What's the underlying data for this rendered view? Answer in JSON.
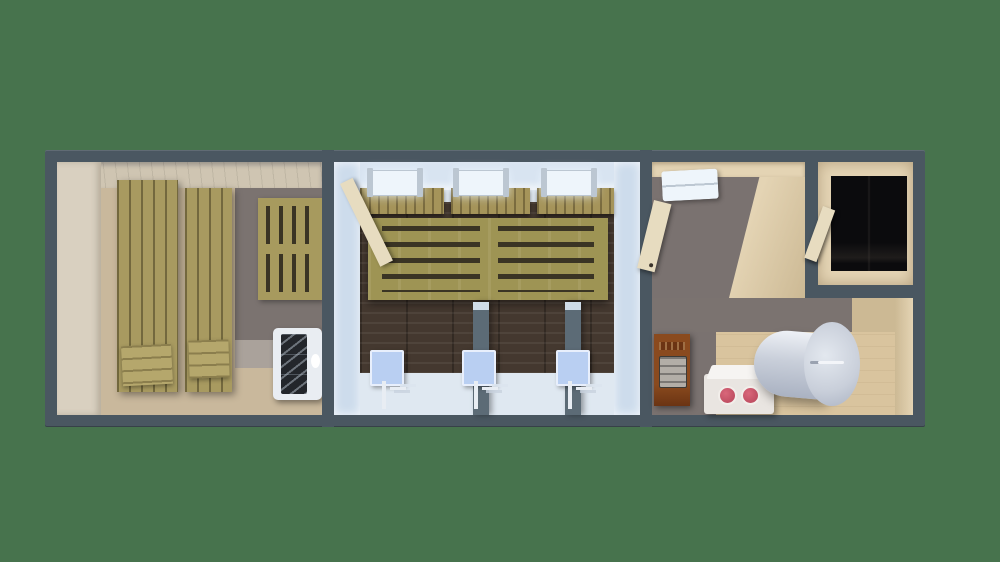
{
  "title": "3D top-down cutaway floor plan of a sauna building",
  "palette": {
    "bg": "#47734d",
    "frame": "#4a5761",
    "sauna-ceiling": "#cfc5b2",
    "sauna-wall": "#d9d0c0",
    "sauna-floor": "#c9b89c",
    "bench": "#a89a60",
    "bench-light": "#b5a76c",
    "pallet": "#a79a5e",
    "slot": "#3a3424",
    "barnwood": "#7b7370",
    "barnwood-light": "#aaa29b",
    "heater": "#e9edf2",
    "grille": "#23262b",
    "tile-wall": "#cddcec",
    "tile-top": "#d8e4f1",
    "tile-floor": "#dfe8f1",
    "dark-wall": "#44382f",
    "cabinet": "#a5945a",
    "shower-bench": "#9e9454",
    "light-fix": "#eef5fb",
    "light-cap": "#bcc7d2",
    "partition": "#5c6b76",
    "partition-top": "#cfdce8",
    "head": "#b9cff2",
    "pipe": "#e8edf3",
    "door": "#e7dcc0",
    "beige": "#e4d4b4",
    "beige-shade": "#ccb994",
    "beige-floor": "#d9c49e",
    "hall-floor": "#7a7270",
    "dark-floor": "#0b0b0d",
    "stove": "#8a4a1e",
    "stove-dark": "#6b3413",
    "stove-panel": "#b3aea7",
    "box": "#e9e5e1",
    "box-top": "#f6f4f2",
    "knob": "#c04f63",
    "boiler-hi": "#eef1f6",
    "boiler-mid": "#c9cfda",
    "boiler-dark": "#aab2c2"
  },
  "scene": {
    "type": "3d-floor-plan-render",
    "view": "top-down cutaway",
    "rooms": [
      {
        "id": "sauna",
        "label": "Sauna room",
        "objects": [
          "lounger-bench",
          "lounger-bench",
          "slatted-backrest-panel",
          "sauna-heater"
        ]
      },
      {
        "id": "shower-room",
        "label": "Shower room",
        "objects": [
          "ceiling-light",
          "ceiling-light",
          "ceiling-light",
          "wall-cabinet",
          "wall-cabinet",
          "wall-cabinet",
          "slatted-bench",
          "open-door",
          "shower-stall",
          "shower-stall",
          "shower-stall"
        ]
      },
      {
        "id": "hallway",
        "label": "Hallway",
        "objects": [
          "ceiling-light",
          "open-door"
        ]
      },
      {
        "id": "entry-room",
        "label": "Dark entry room",
        "objects": [
          "open-door"
        ]
      },
      {
        "id": "boiler-room",
        "label": "Boiler room",
        "objects": [
          "wood-stove",
          "control-box",
          "water-boiler-tank"
        ]
      }
    ]
  }
}
